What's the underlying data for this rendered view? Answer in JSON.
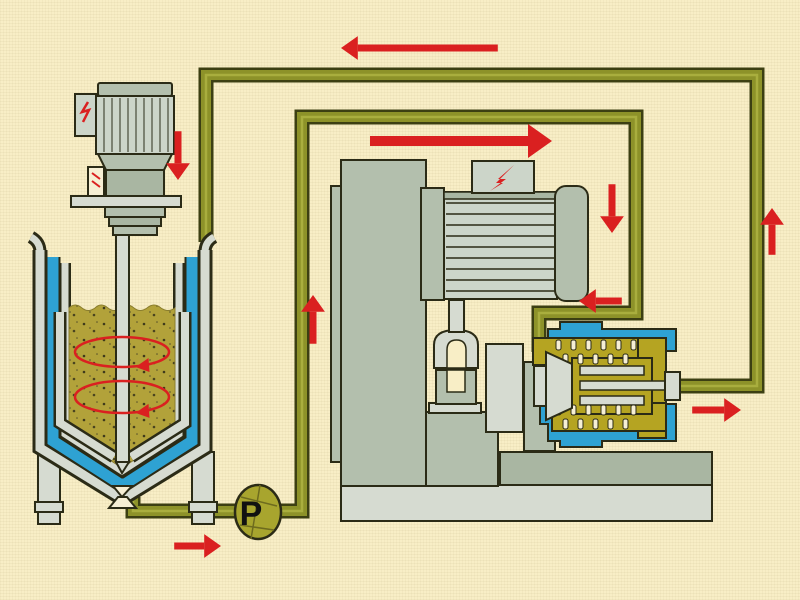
{
  "diagram": {
    "pump_label": "P",
    "colors": {
      "background": "#f8eec6",
      "cream": "#f6efd4",
      "outline": "#2b2b16",
      "pipe-edge": "#3c3f12",
      "pipe-core": "#8d9229",
      "pipe-light": "#a9ae3e",
      "product": "#b2a23a",
      "mill-product": "#b5a422",
      "coolant": "#2ea2d3",
      "machine": "#b3bfad",
      "machine-dark": "#a9b6a2",
      "metal-light": "#d6dbd1",
      "motor-body": "#ccd5c9",
      "pump-fill": "#a8a52e",
      "red": "#da2020",
      "label": "#111111"
    },
    "flow_arrows": [
      {
        "name": "return-to-tank-left",
        "x": 341,
        "y": 48,
        "dir": "left",
        "len": 140,
        "w": 7
      },
      {
        "name": "feed-forward-right",
        "x": 552,
        "y": 141,
        "dir": "right",
        "len": 158,
        "w": 10
      },
      {
        "name": "agitator-down",
        "x": 178,
        "y": 180,
        "dir": "down",
        "len": 32,
        "w": 7
      },
      {
        "name": "pump-riser-up",
        "x": 313,
        "y": 295,
        "dir": "up",
        "len": 32,
        "w": 7
      },
      {
        "name": "mill-inlet-down",
        "x": 612,
        "y": 233,
        "dir": "down",
        "len": 32,
        "w": 7
      },
      {
        "name": "into-mill-left",
        "x": 579,
        "y": 301,
        "dir": "left",
        "len": 26,
        "w": 7
      },
      {
        "name": "return-riser-up",
        "x": 772,
        "y": 208,
        "dir": "up",
        "len": 30,
        "w": 7
      },
      {
        "name": "mill-outlet-right",
        "x": 741,
        "y": 410,
        "dir": "right",
        "len": 32,
        "w": 7
      },
      {
        "name": "tank-outlet-right",
        "x": 221,
        "y": 546,
        "dir": "right",
        "len": 30,
        "w": 7
      }
    ],
    "swirl_arrows": [
      {
        "cx": 122,
        "cy": 352,
        "rx": 47,
        "ry": 15
      },
      {
        "cx": 122,
        "cy": 397,
        "rx": 47,
        "ry": 16
      }
    ]
  }
}
